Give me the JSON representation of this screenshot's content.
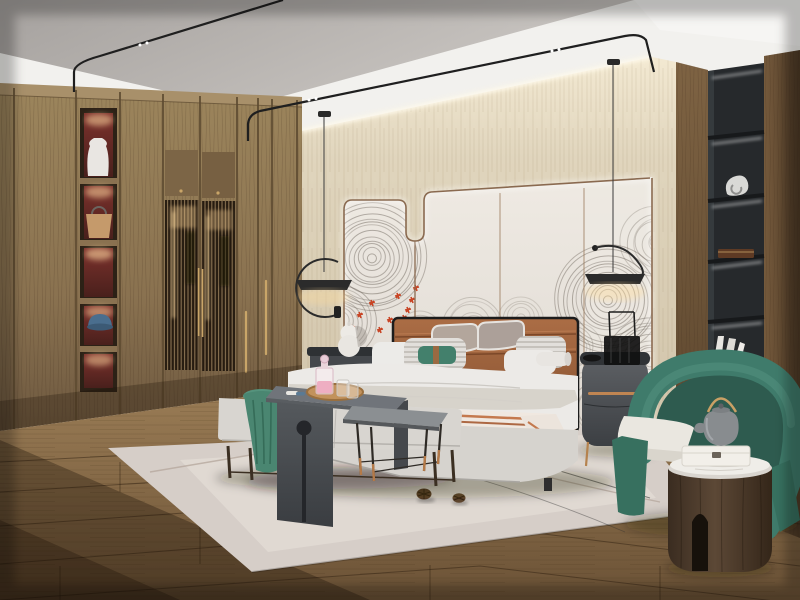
{
  "scene": {
    "description": "Photorealistic render of a modern Chinese-style bedroom: wooden wardrobe wall with lit display niches and lattice doors on the left, upholstered bed with cognac leather headboard against a back-lit paneled feature wall with wave-ring mural art, black pendant lamps, dark oval nightstands, bench with waterfall console at the bed foot, green barrel armchair with round wood side table on the right beside a black recessed shelf column, light rug over warm plank flooring.",
    "palette": {
      "ceiling_gray": "#b3afac",
      "ceiling_white": "#f2f1ee",
      "cove_glow": "#fff6e0",
      "beige_wall": "#dfd4bd",
      "panel_wall": "#e8e3dc",
      "copper_trim": "#8a6a50",
      "wardrobe_wood": "#8f7755",
      "niche_red": "#6e2b28",
      "brass_handle": "#c9a568",
      "right_wood": "#6f5539",
      "shelf_black": "#26292c",
      "headboard_cognac": "#9e603c",
      "bedding_white": "#eceae7",
      "teal_pillow": "#43806c",
      "throw_stripe": "#c4794e",
      "bench_gray": "#d8d5d0",
      "console_charcoal": "#53575b",
      "armchair_green": "#3f7b6b",
      "side_table_wood": "#4a392c",
      "rug": "#d6cec8",
      "floor_wood": "#85664a",
      "mural_stroke": "#6f675e",
      "mural_red": "#c84424"
    },
    "objects": [
      "wardrobe-with-display-niches",
      "lattice-doors",
      "white-vase",
      "tan-handbag",
      "blue-cap",
      "ceiling-track-lights",
      "pendant-lamp-left",
      "pendant-lamp-right",
      "feature-wall-led-trim",
      "wave-ring-mural",
      "red-blossom-accents",
      "hanging-rod-decor",
      "bed",
      "leather-headboard",
      "pillows",
      "teal-lumbar-pillow",
      "striped-throw",
      "left-nightstand",
      "gourd-table-lamp",
      "right-nightstand",
      "trolley-decor-object",
      "foot-bench",
      "green-throw",
      "waterfall-console",
      "drink-tray",
      "pink-decanter",
      "glasses",
      "metal-side-table",
      "area-rug",
      "pinecones",
      "black-shelf-column",
      "sculpture",
      "wooden-box",
      "books",
      "green-armchair",
      "round-wood-side-table",
      "gray-teapot",
      "white-box",
      "plank-floor"
    ],
    "mural": {
      "stroke": "#6f675e",
      "clusters": [
        [
          372,
          258,
          54,
          4.5,
          0.5
        ],
        [
          340,
          322,
          40,
          4.5,
          0.45
        ],
        [
          420,
          332,
          26,
          4.5,
          0.3
        ],
        [
          472,
          326,
          30,
          5,
          0.28
        ],
        [
          521,
          318,
          24,
          4.5,
          0.26
        ],
        [
          608,
          300,
          58,
          4.5,
          0.5
        ],
        [
          650,
          362,
          48,
          4.5,
          0.45
        ],
        [
          575,
          348,
          28,
          5,
          0.3
        ],
        [
          657,
          243,
          36,
          5,
          0.35
        ],
        [
          600,
          410,
          36,
          5,
          0.38
        ]
      ],
      "red_accents": [
        [
          398,
          296
        ],
        [
          408,
          310
        ],
        [
          390,
          320
        ],
        [
          416,
          288
        ],
        [
          372,
          303
        ],
        [
          360,
          315
        ],
        [
          352,
          328
        ],
        [
          380,
          330
        ],
        [
          404,
          318
        ],
        [
          412,
          300
        ]
      ]
    }
  }
}
